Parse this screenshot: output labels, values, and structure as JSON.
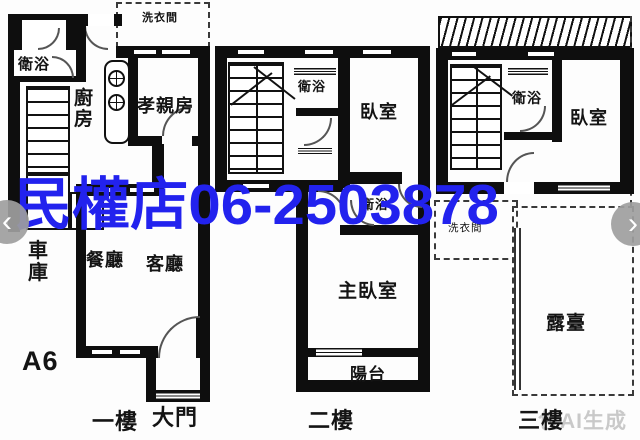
{
  "watermark": {
    "text": "民權店06-2503878",
    "color": "#2222ee"
  },
  "ai_watermark": {
    "text": "包AI生成"
  },
  "nav": {
    "prev": "‹",
    "next": "›"
  },
  "floor1": {
    "floor_label": "一樓",
    "unit_label": "A6",
    "rooms": {
      "laundry": "洗衣間",
      "bath": "衛浴",
      "kitchen": "廚房",
      "parents_room": "孝親房",
      "garage": "車庫",
      "dining": "餐廳",
      "living": "客廳",
      "main_door": "大門"
    }
  },
  "floor2": {
    "floor_label": "二樓",
    "rooms": {
      "bath_upper": "衛浴",
      "bedroom": "臥室",
      "bath_lower": "衛浴",
      "master_bedroom": "主臥室",
      "balcony": "陽台"
    }
  },
  "floor3": {
    "floor_label": "三樓",
    "rooms": {
      "bath": "衛浴",
      "bedroom": "臥室",
      "laundry": "洗衣間",
      "terrace": "露臺"
    }
  }
}
